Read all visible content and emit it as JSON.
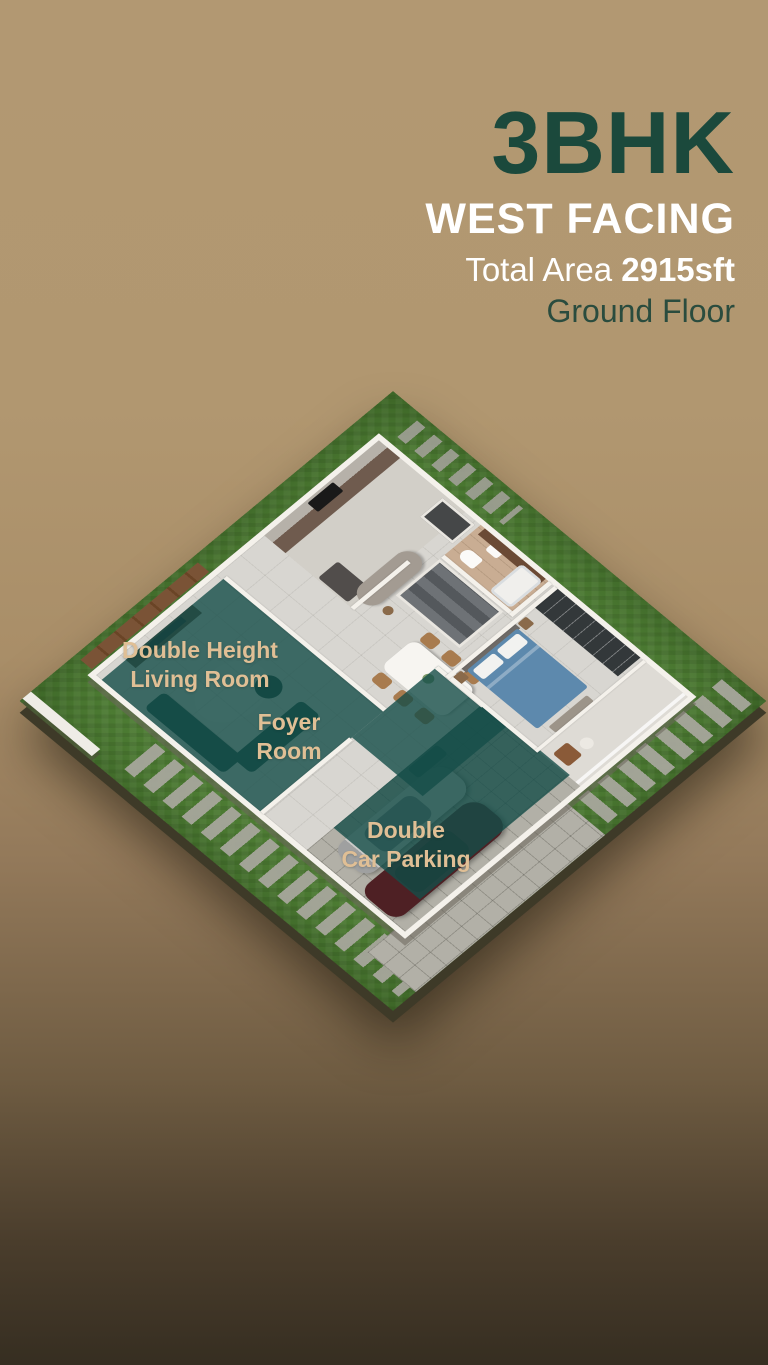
{
  "header": {
    "bhk": "3BHK",
    "facing": "WEST FACING",
    "total_area_label": "Total Area",
    "total_area_value": "2915sft",
    "floor": "Ground Floor"
  },
  "plan": {
    "labels": {
      "living": {
        "line1": "Double Height",
        "line2": "Living Room"
      },
      "foyer": {
        "line1": "Foyer",
        "line2": "Room"
      },
      "parking": {
        "line1": "Double",
        "line2": "Car Parking"
      }
    }
  },
  "colors": {
    "background_top": "#b29872",
    "background_bottom": "#362e21",
    "title_green": "#1b493c",
    "title_white": "#ffffff",
    "room_label_tan": "#e0bf95",
    "highlight_teal": "rgba(21,77,72,0.8)",
    "grass_green": "#4e7d34",
    "bed_blue": "#5d89ad",
    "car_maroon": "#4e2024",
    "car_silver": "#cacac8"
  }
}
